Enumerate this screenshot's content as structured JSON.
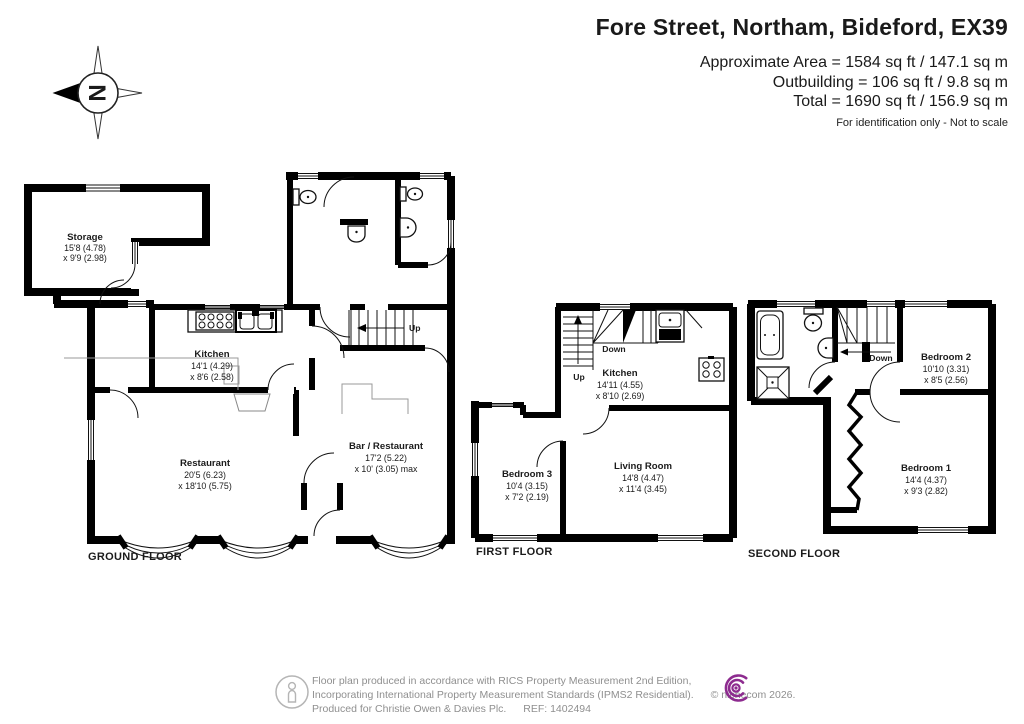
{
  "header": {
    "title": "Fore Street, Northam, Bideford, EX39",
    "area_line1": "Approximate Area = 1584 sq ft / 147.1 sq m",
    "area_line2": "Outbuilding = 106 sq ft / 9.8 sq m",
    "area_line3": "Total = 1690 sq ft / 156.9 sq m",
    "disclaimer": "For identification only - Not to scale"
  },
  "compass": {
    "label": "N"
  },
  "floors": [
    {
      "label": "GROUND FLOOR",
      "stairs": {
        "up": "Up"
      },
      "rooms": [
        {
          "name": "Storage",
          "dims1": "15'8 (4.78)",
          "dims2": "x 9'9 (2.98)"
        },
        {
          "name": "Kitchen",
          "dims1": "14'1 (4.29)",
          "dims2": "x 8'6 (2.58)"
        },
        {
          "name": "Restaurant",
          "dims1": "20'5 (6.23)",
          "dims2": "x 18'10 (5.75)"
        },
        {
          "name": "Bar / Restaurant",
          "dims1": "17'2 (5.22)",
          "dims2": "x 10' (3.05) max"
        }
      ]
    },
    {
      "label": "FIRST FLOOR",
      "stairs": {
        "up": "Up",
        "down": "Down"
      },
      "rooms": [
        {
          "name": "Kitchen",
          "dims1": "14'11 (4.55)",
          "dims2": "x 8'10 (2.69)"
        },
        {
          "name": "Bedroom 3",
          "dims1": "10'4 (3.15)",
          "dims2": "x 7'2 (2.19)"
        },
        {
          "name": "Living Room",
          "dims1": "14'8 (4.47)",
          "dims2": "x 11'4 (3.45)"
        }
      ]
    },
    {
      "label": "SECOND FLOOR",
      "stairs": {
        "down": "Down"
      },
      "rooms": [
        {
          "name": "Bedroom 2",
          "dims1": "10'10 (3.31)",
          "dims2": "x 8'5 (2.56)"
        },
        {
          "name": "Bedroom 1",
          "dims1": "14'4 (4.37)",
          "dims2": "x 9'3 (2.82)"
        }
      ]
    }
  ],
  "footer": {
    "line1": "Floor plan produced in accordance with RICS Property Measurement 2nd Edition,",
    "line2": "Incorporating International Property Measurement Standards (IPMS2 Residential).",
    "copyright": "© nichecom 2026.",
    "line3": "Produced for Christie Owen & Davies Plc.",
    "ref": "REF: 1402494",
    "logo_color": "#8d2b8f"
  }
}
